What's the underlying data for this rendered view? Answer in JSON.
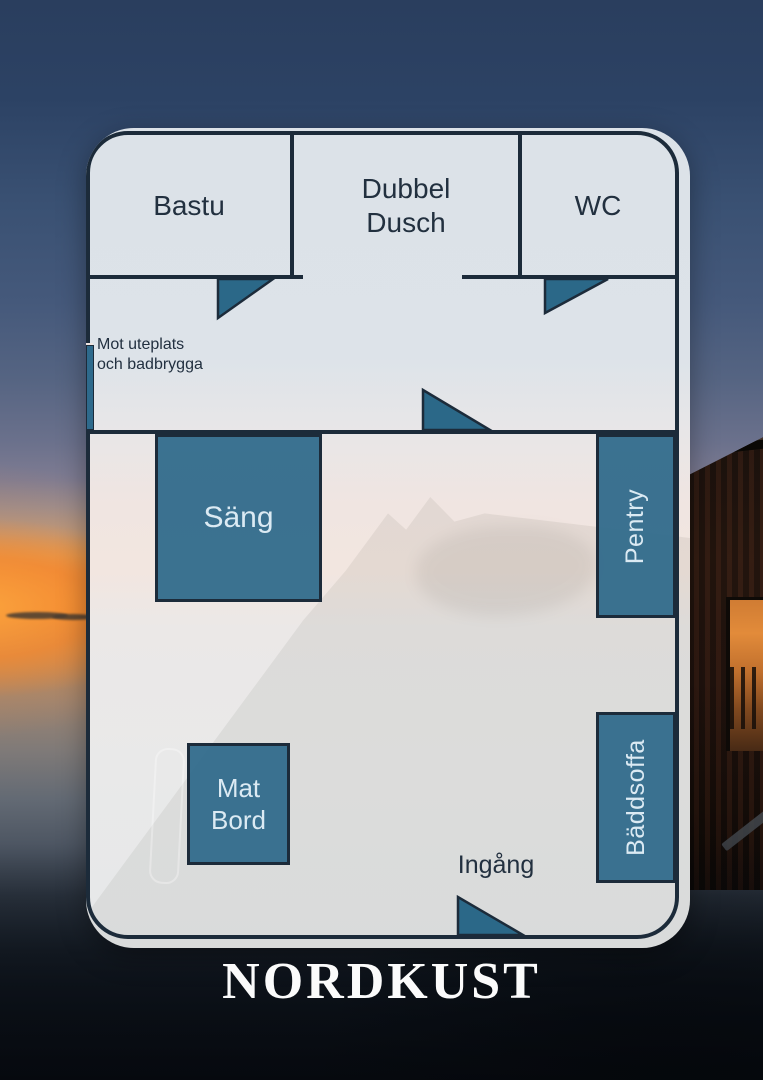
{
  "brand": {
    "name": "NORDKUST"
  },
  "floorplan": {
    "rooms": [
      {
        "id": "bastu",
        "label": "Bastu"
      },
      {
        "id": "dubbel-dusch",
        "label": "Dubbel\nDusch"
      },
      {
        "id": "wc",
        "label": "WC"
      }
    ],
    "furniture": [
      {
        "id": "sang",
        "label": "Säng"
      },
      {
        "id": "pentry",
        "label": "Pentry"
      },
      {
        "id": "mat-bord",
        "label": "Mat\nBord"
      },
      {
        "id": "baddsoffa",
        "label": "Bäddsoffa"
      }
    ],
    "annotations": [
      {
        "id": "mot-uteplats",
        "label": "Mot uteplats\noch badbrygga"
      },
      {
        "id": "ingang",
        "label": "Ingång"
      }
    ],
    "colors": {
      "wall": "#1c2b3a",
      "furniture_fill": "#2e6a8c",
      "panel": "#e5eaee",
      "sunset_accent": "#f18a39",
      "brand_text": "#fbfbfb"
    }
  }
}
